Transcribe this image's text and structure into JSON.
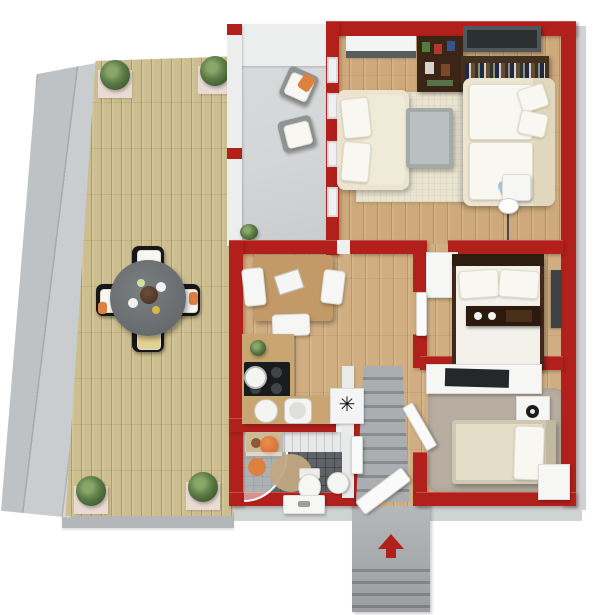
{
  "scene": {
    "type": "3d-floor-plan-render",
    "view": "top-down-isometric",
    "walls": "red",
    "rooms": [
      {
        "id": "terrace-deck",
        "floor": "wood-planks",
        "objects": [
          "outdoor-dining-table",
          "four-black-chairs",
          "corner-planters",
          "side-steps"
        ]
      },
      {
        "id": "covered-patio",
        "floor": "concrete",
        "objects": [
          "lounge-chair-with-orange-pillow",
          "lounge-chair",
          "small-plant"
        ]
      },
      {
        "id": "living-room",
        "floor": "wood",
        "objects": [
          "area-rug",
          "two-seat-sofa",
          "corner-sofa",
          "coffee-table",
          "bookshelf",
          "media-shelf",
          "tv-panel",
          "side-table",
          "floor-lamp",
          "window-alcove"
        ]
      },
      {
        "id": "kitchen-dining",
        "floor": "wood",
        "objects": [
          "dining-table",
          "laptop",
          "three-chairs",
          "kitchen-counter",
          "cooktop",
          "pot",
          "plant",
          "double-sink"
        ]
      },
      {
        "id": "hallway",
        "floor": "wood",
        "objects": [
          "staircase-down",
          "coat-rack"
        ]
      },
      {
        "id": "bedroom-1",
        "floor": "wood",
        "objects": [
          "double-bed",
          "bed-bench-tray",
          "wardrobe",
          "wall-mirror"
        ]
      },
      {
        "id": "bedroom-2",
        "floor": "wood-with-rug",
        "objects": [
          "single-bed",
          "desk",
          "desk-tv",
          "nightstand-lamp",
          "wardrobe"
        ]
      },
      {
        "id": "bathroom",
        "floor": "dark-tile",
        "objects": [
          "corner-shower",
          "shower-mat",
          "round-rug",
          "toilet",
          "bidet",
          "cabinet-with-towels",
          "window-vanity"
        ]
      },
      {
        "id": "entrance",
        "floor": "concrete-steps",
        "objects": [
          "open-door",
          "direction-arrow"
        ]
      }
    ],
    "entrance_arrow": {
      "direction": "up"
    }
  },
  "glyphs": {
    "coat_rack": "✳"
  },
  "colors": {
    "wall-red": "#b2201c",
    "wall-white-face": "#eceded",
    "outer-band": "#d0d3d4",
    "deck-wood": "#ccbe8f",
    "floor-wood": "#cda97b",
    "patio-gray": "#d3d5d6",
    "fascia-gray": "#b4b7b9",
    "rug-beige": "#e9e3d0",
    "sofa-cream": "#ece4cf",
    "cushion-white": "#f8f7f1",
    "dark-wood": "#3b2517",
    "tv-gray": "#50565a",
    "table-gray": "#a4a9a9",
    "stairs-gray": "#a0a3a5",
    "tile-gray": "#5e6367",
    "bedroom-rug": "#b7ada0",
    "linen-white": "#f3f1ea",
    "linen-beige": "#e4ddc7",
    "entrance-gray": "#a8abad",
    "accent-orange": "#dd8140",
    "accent-blue": "#a6c7db",
    "plant-green": "#5d7d48",
    "planter-pink": "#e9dad4",
    "patio-chair-gray": "#909496",
    "outdoor-table-gray": "#676b6e",
    "chair-black": "#17171a"
  }
}
